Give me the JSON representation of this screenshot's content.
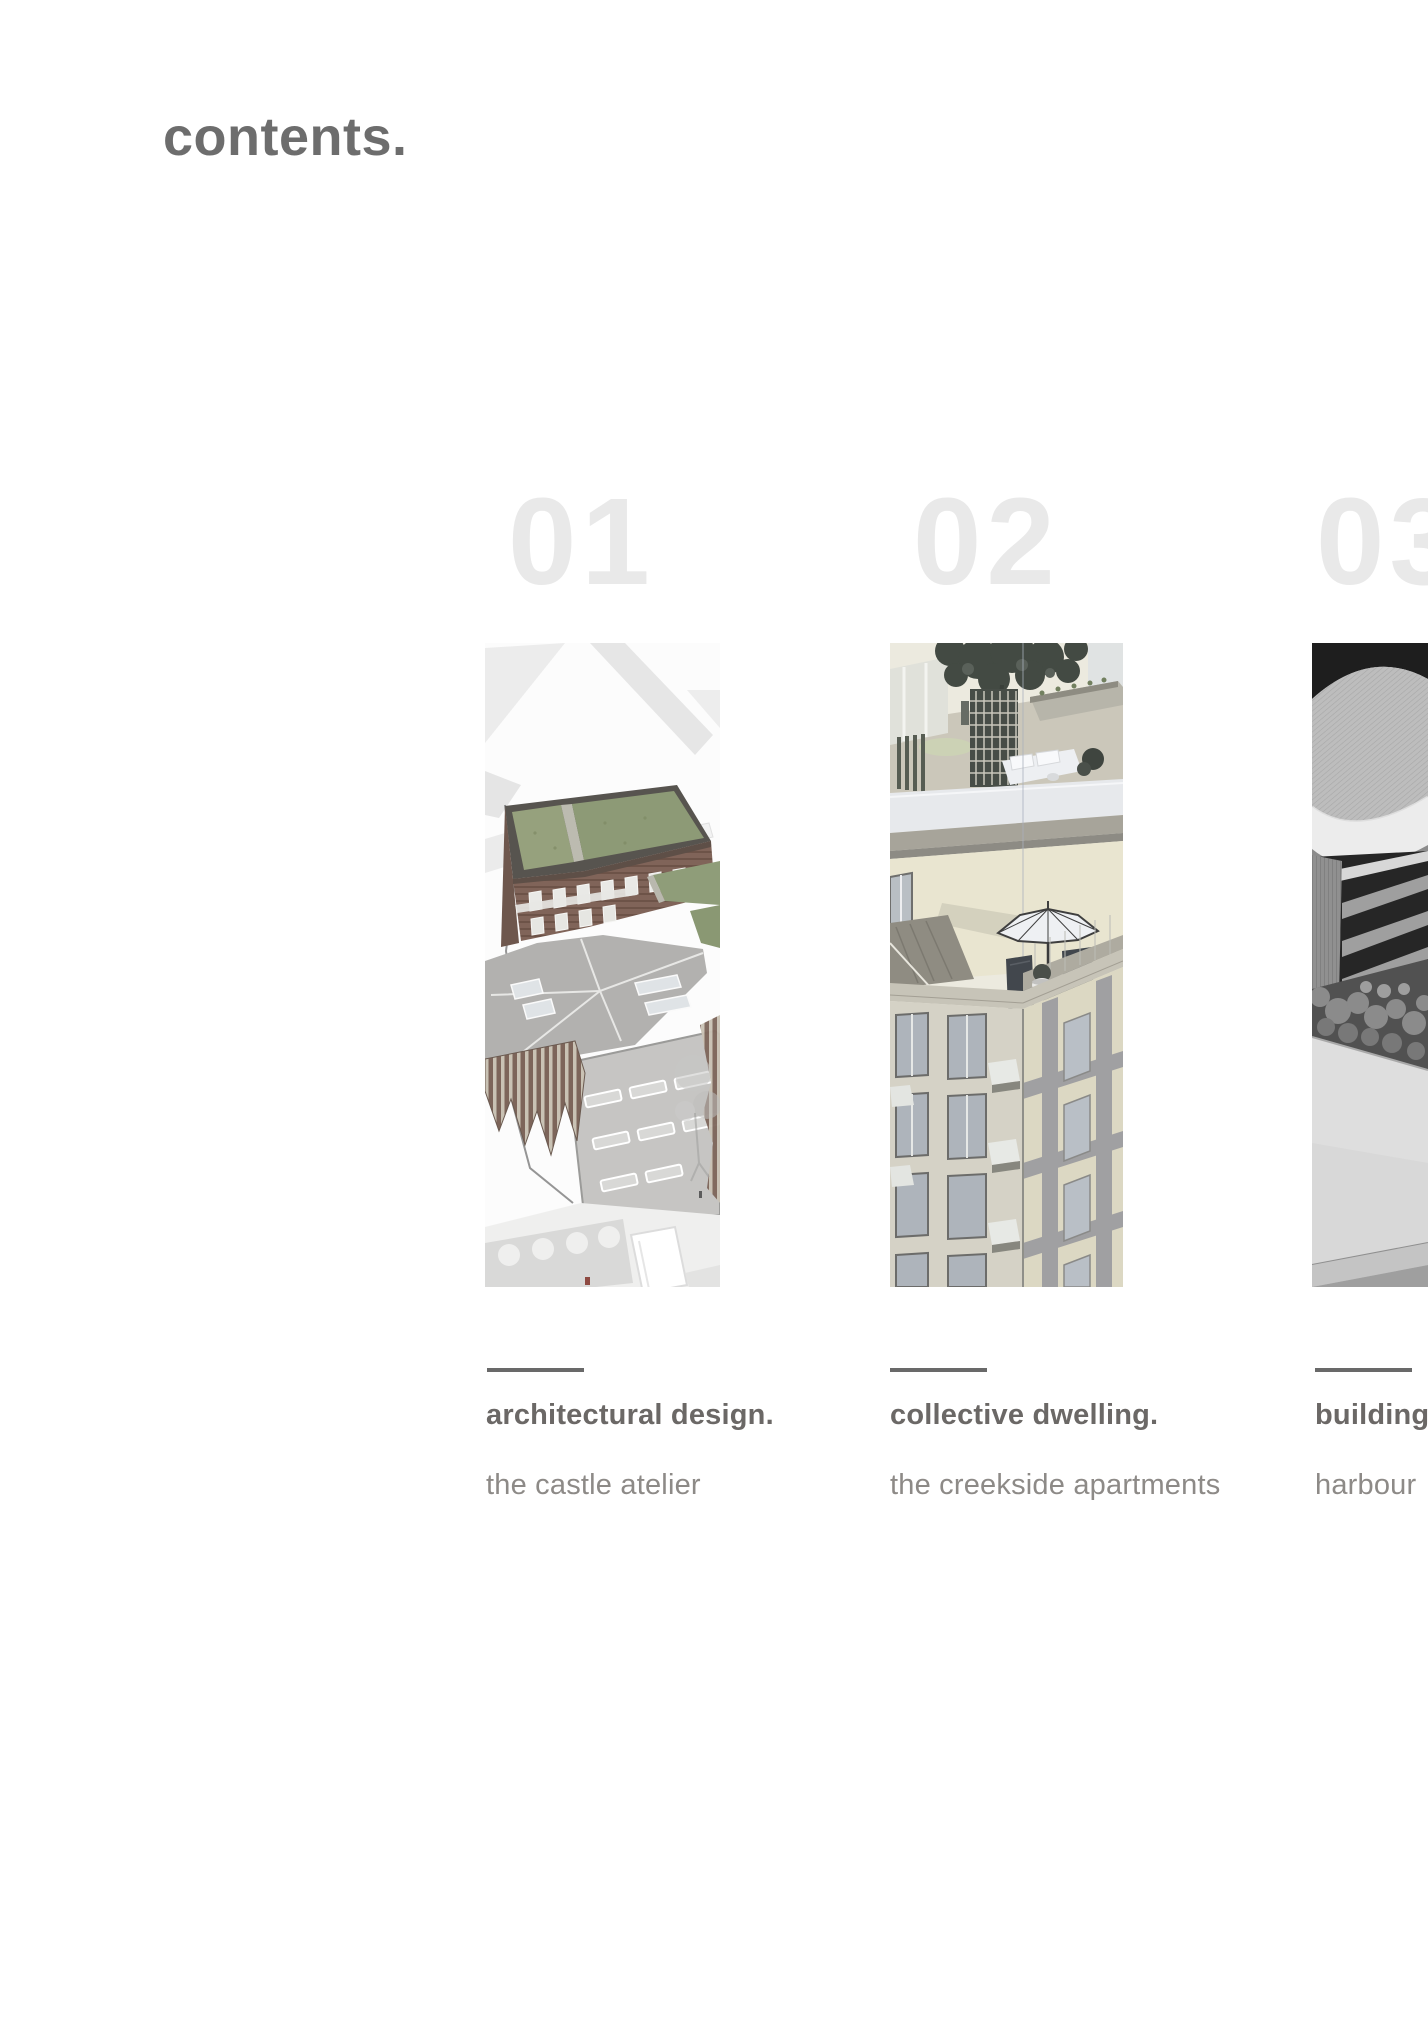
{
  "page": {
    "title": "contents."
  },
  "colors": {
    "background": "#ffffff",
    "heading_gray": "#6d6d6d",
    "big_number_gray": "#e9e9e9",
    "divider_gray": "#696969",
    "project_title_gray": "#6b6866",
    "project_subtitle_gray": "#8d8a87"
  },
  "sections": [
    {
      "number": "01",
      "title": "architectural design.",
      "subtitle": "the castle atelier",
      "image_alt": "aerial axonometric render of brick atelier buildings with green roofs over a white site plan"
    },
    {
      "number": "02",
      "title": "collective dwelling.",
      "subtitle": "the creekside apartments",
      "image_alt": "perspective render looking down an apartment corner with roof terrace, tree, parasol and balconies"
    },
    {
      "number": "03",
      "title": "building",
      "subtitle": "harbour",
      "image_alt": "black and white photo of a physical model with ribbed roof and louvred facade, cropped at page edge"
    }
  ]
}
